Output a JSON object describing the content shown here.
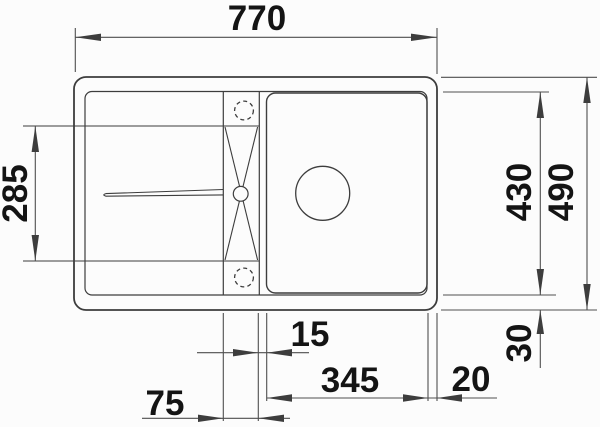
{
  "diagram": {
    "labels": {
      "width_top": "770",
      "drainer_depth_left": "285",
      "inner_depth_right": "430",
      "outer_depth_right": "490",
      "gap_divider_to_bowl": "15",
      "bowl_width": "345",
      "rim_right": "20",
      "rim_bottom": "30",
      "divider_width": "75"
    },
    "colors": {
      "background": "#fcfcfc",
      "drawing_line": "#3d3d3d",
      "dimension_line": "#4f4f4f",
      "text": "#141414"
    }
  }
}
